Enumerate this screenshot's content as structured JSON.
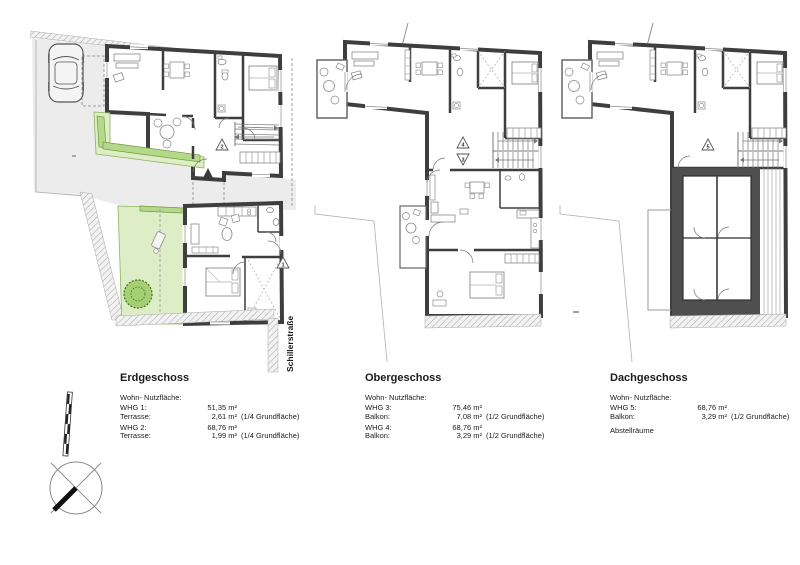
{
  "colors": {
    "wall": "#3e3e3e",
    "site_gray": "#ececec",
    "terrace_green": "#ddeec6",
    "hedge_green": "#b5d88a",
    "tree_green": "#a5cf73",
    "line_gray": "#8a8a8a"
  },
  "plans": [
    {
      "title": "Erdgeschoss",
      "street_label": "Schillerstraße",
      "markers": {
        "upper_unit": "2",
        "lower_unit": "1"
      },
      "table": {
        "header": "Wohn- Nutzfläche:",
        "rows": [
          {
            "label": "WHG 1:",
            "value": "51,35 m²",
            "note": ""
          },
          {
            "label": "Terrasse:",
            "value": "2,61 m²",
            "note": "(1/4 Grundfläche)"
          },
          {
            "label": "WHG 2:",
            "value": "68,76 m²",
            "note": ""
          },
          {
            "label": "Terrasse:",
            "value": "1,99 m²",
            "note": "(1/4 Grundfläche)"
          }
        ]
      }
    },
    {
      "title": "Obergeschoss",
      "markers": {
        "stair_up": "4",
        "stair_down": "3"
      },
      "table": {
        "header": "Wohn- Nutzfläche:",
        "rows": [
          {
            "label": "WHG 3:",
            "value": "75,46 m²",
            "note": ""
          },
          {
            "label": "Balkon:",
            "value": "7,08 m²",
            "note": "(1/2 Grundfläche)"
          },
          {
            "label": "WHG 4:",
            "value": "68,76 m²",
            "note": ""
          },
          {
            "label": "Balkon:",
            "value": "3,29 m²",
            "note": "(1/2 Grundfläche)"
          }
        ]
      }
    },
    {
      "title": "Dachgeschoss",
      "markers": {
        "stair_up": "5"
      },
      "table": {
        "header": "Wohn- Nutzfläche:",
        "rows": [
          {
            "label": "WHG 5:",
            "value": "68,76 m²",
            "note": ""
          },
          {
            "label": "Balkon:",
            "value": "3,29 m²",
            "note": "(1/2 Grundfläche)"
          },
          {
            "label": "Abstellräume",
            "value": "",
            "note": ""
          }
        ]
      }
    }
  ]
}
